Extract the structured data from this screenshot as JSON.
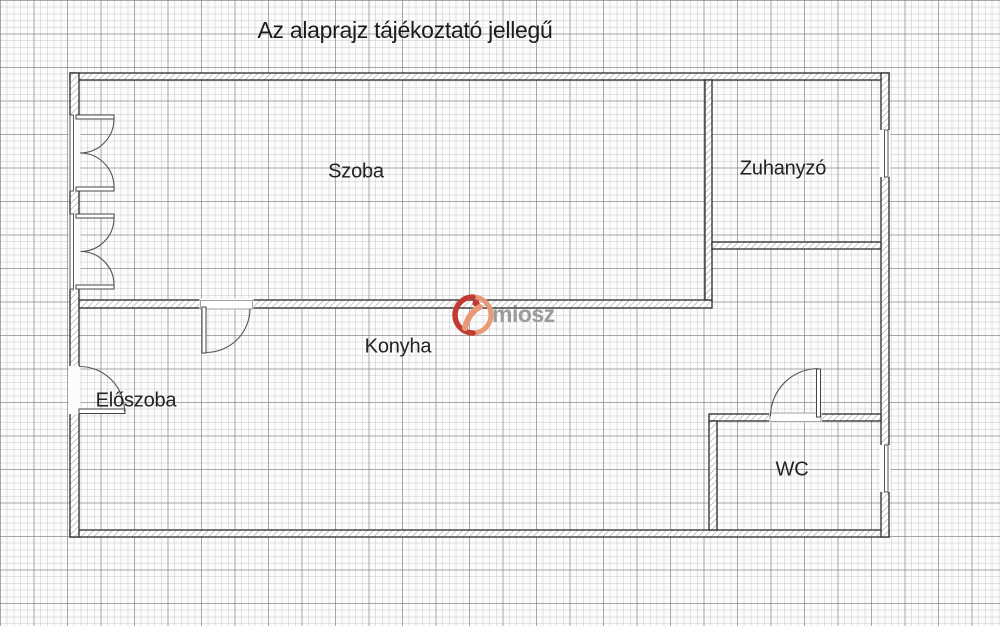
{
  "title": "Az alaprajz tájékoztató jellegű",
  "rooms": {
    "szoba": "Szoba",
    "zuhanyzo": "Zuhanyzó",
    "konyha": "Konyha",
    "eloszoba": "Előszoba",
    "wc": "WC"
  },
  "watermark": {
    "text": "miosz",
    "logo_red": "#c23b32",
    "logo_salmon": "#e89a78",
    "text_color": "#9b9b9b"
  },
  "colors": {
    "paper": "#fcfcfc",
    "grid_minor": "#e3e3e3",
    "grid_major": "#b9b9b9",
    "wall_outline": "#2b2b2b",
    "wall_hatch": "#9a9a9a",
    "door_arc": "#555555",
    "label_text": "#222222"
  }
}
